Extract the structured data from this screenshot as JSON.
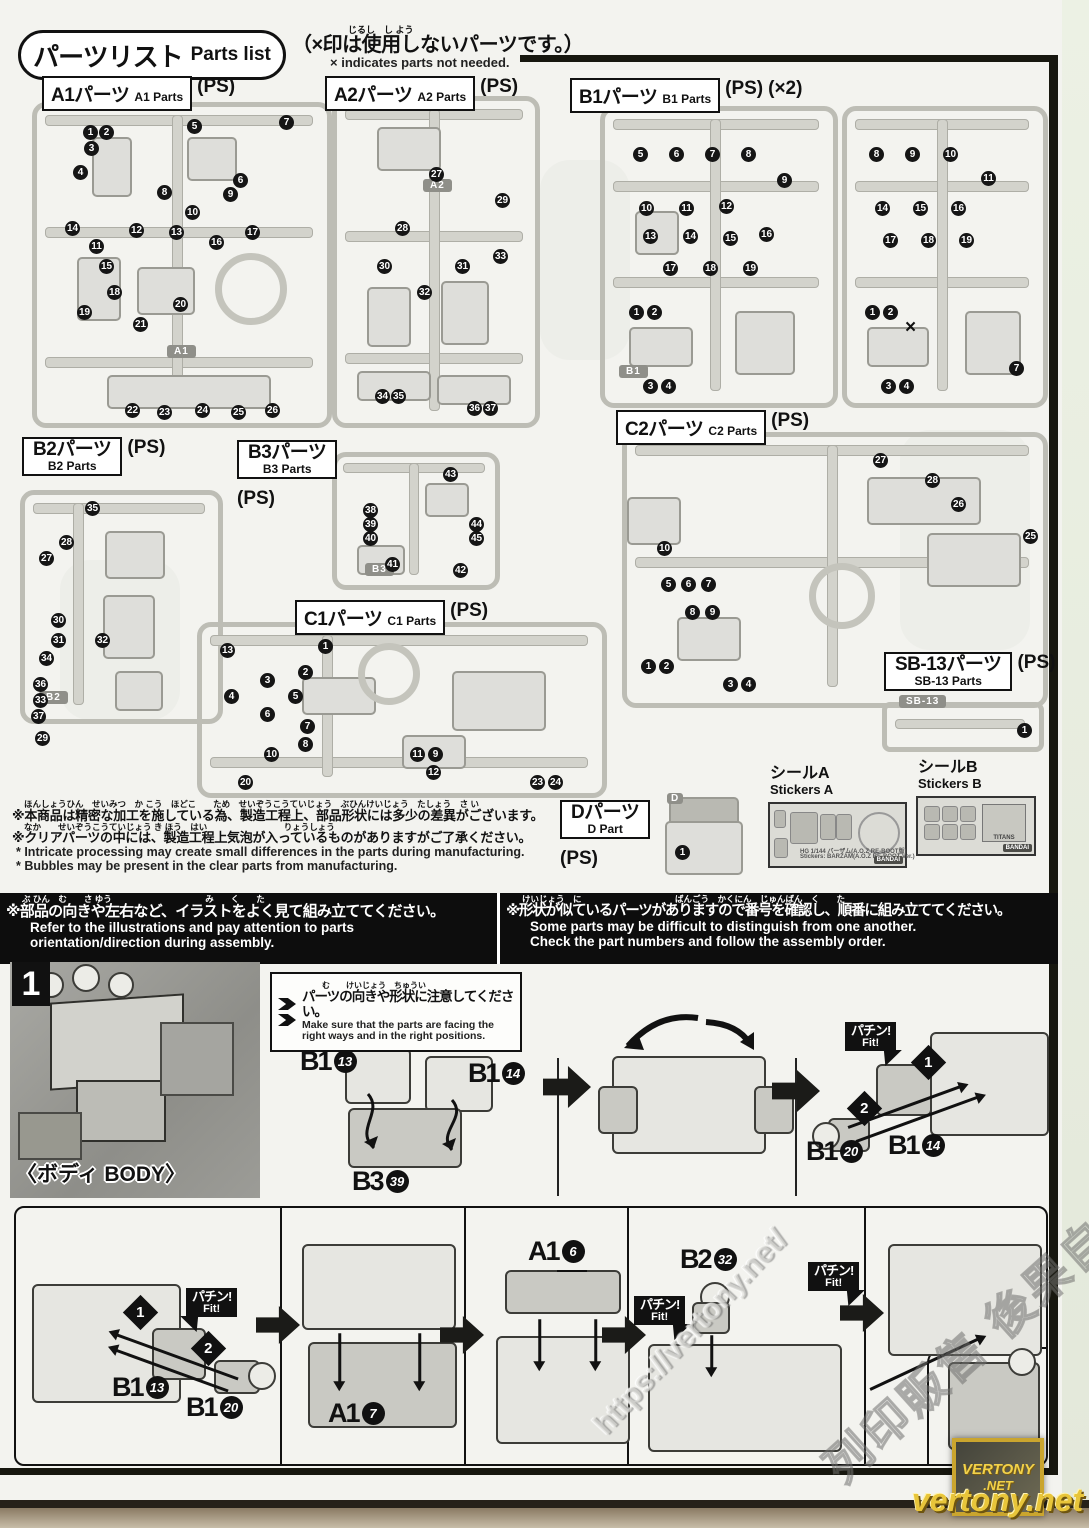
{
  "header": {
    "title_jp": "パーツリスト",
    "title_en": "Parts list",
    "x_note_furigana": "じるし　し よう",
    "x_note_jp": "（×印は使用しないパーツです。）",
    "x_note_en": "× indicates parts not needed."
  },
  "sections": {
    "a1": {
      "jp": "A1パーツ",
      "en": "A1 Parts",
      "ps": "(PS)",
      "tag": "A1"
    },
    "a2": {
      "jp": "A2パーツ",
      "en": "A2 Parts",
      "ps": "(PS)",
      "tag": "A2"
    },
    "b1": {
      "jp": "B1パーツ",
      "en": "B1 Parts",
      "ps": "(PS)",
      "qty": "(×2)",
      "tag": "B1"
    },
    "b2": {
      "jp": "B2パーツ",
      "en": "B2 Parts",
      "ps": "(PS)",
      "tag": "B2"
    },
    "b3": {
      "jp": "B3パーツ",
      "en": "B3 Parts",
      "ps": "(PS)",
      "tag": "B3"
    },
    "c1": {
      "jp": "C1パーツ",
      "en": "C1 Parts",
      "ps": "(PS)"
    },
    "c2": {
      "jp": "C2パーツ",
      "en": "C2 Parts",
      "ps": "(PS)"
    },
    "sb13": {
      "jp": "SB-13パーツ",
      "en": "SB-13 Parts",
      "ps": "(PS)",
      "tag": "SB-13"
    },
    "d": {
      "jp": "Dパーツ",
      "en": "D Part",
      "ps": "(PS)",
      "tag": "D"
    }
  },
  "sprues": {
    "a1": [
      [
        1,
        46,
        18
      ],
      [
        2,
        62,
        18
      ],
      [
        3,
        47,
        34
      ],
      [
        4,
        36,
        58
      ],
      [
        5,
        150,
        12
      ],
      [
        7,
        242,
        8
      ],
      [
        6,
        196,
        66
      ],
      [
        8,
        120,
        78
      ],
      [
        9,
        186,
        80
      ],
      [
        10,
        148,
        98
      ],
      [
        14,
        28,
        114
      ],
      [
        12,
        92,
        116
      ],
      [
        13,
        132,
        118
      ],
      [
        11,
        52,
        132
      ],
      [
        16,
        172,
        128
      ],
      [
        17,
        208,
        118
      ],
      [
        15,
        62,
        152
      ],
      [
        18,
        70,
        178
      ],
      [
        19,
        40,
        198
      ],
      [
        20,
        136,
        190
      ],
      [
        21,
        96,
        210
      ],
      [
        22,
        88,
        296
      ],
      [
        23,
        120,
        298
      ],
      [
        24,
        158,
        296
      ],
      [
        25,
        194,
        298
      ],
      [
        26,
        228,
        296
      ]
    ],
    "a2": [
      [
        27,
        92,
        66
      ],
      [
        28,
        58,
        120
      ],
      [
        29,
        158,
        92
      ],
      [
        30,
        40,
        158
      ],
      [
        31,
        118,
        158
      ],
      [
        32,
        80,
        184
      ],
      [
        33,
        156,
        148
      ],
      [
        34,
        38,
        288
      ],
      [
        35,
        54,
        288
      ],
      [
        36,
        130,
        300
      ],
      [
        37,
        146,
        300
      ]
    ],
    "b1a": [
      [
        5,
        28,
        36
      ],
      [
        6,
        64,
        36
      ],
      [
        7,
        100,
        36
      ],
      [
        8,
        136,
        36
      ],
      [
        9,
        172,
        62
      ],
      [
        10,
        34,
        90
      ],
      [
        11,
        74,
        90
      ],
      [
        12,
        114,
        88
      ],
      [
        13,
        38,
        118
      ],
      [
        14,
        78,
        118
      ],
      [
        15,
        118,
        120
      ],
      [
        16,
        154,
        116
      ],
      [
        17,
        58,
        150
      ],
      [
        18,
        98,
        150
      ],
      [
        19,
        138,
        150
      ],
      [
        1,
        24,
        194
      ],
      [
        2,
        42,
        194
      ],
      [
        3,
        38,
        268
      ],
      [
        4,
        56,
        268
      ]
    ],
    "b1b": [
      [
        8,
        22,
        36
      ],
      [
        9,
        58,
        36
      ],
      [
        10,
        96,
        36
      ],
      [
        11,
        134,
        60
      ],
      [
        14,
        28,
        90
      ],
      [
        15,
        66,
        90
      ],
      [
        16,
        104,
        90
      ],
      [
        17,
        36,
        122
      ],
      [
        18,
        74,
        122
      ],
      [
        19,
        112,
        122
      ],
      [
        1,
        18,
        194
      ],
      [
        2,
        36,
        194
      ],
      [
        "x",
        58,
        206
      ],
      [
        3,
        34,
        268
      ],
      [
        4,
        52,
        268
      ],
      [
        7,
        162,
        250
      ]
    ],
    "b2": [
      [
        35,
        60,
        6
      ],
      [
        28,
        34,
        40
      ],
      [
        27,
        14,
        56
      ],
      [
        30,
        26,
        118
      ],
      [
        31,
        26,
        138
      ],
      [
        32,
        70,
        138
      ],
      [
        34,
        14,
        156
      ],
      [
        36,
        8,
        182
      ],
      [
        33,
        8,
        198
      ],
      [
        37,
        6,
        214
      ],
      [
        29,
        10,
        236
      ]
    ],
    "b3": [
      [
        43,
        106,
        10
      ],
      [
        38,
        26,
        46
      ],
      [
        39,
        26,
        60
      ],
      [
        40,
        26,
        74
      ],
      [
        44,
        132,
        60
      ],
      [
        45,
        132,
        74
      ],
      [
        41,
        48,
        100
      ],
      [
        42,
        116,
        106
      ]
    ],
    "c1": [
      [
        13,
        18,
        16
      ],
      [
        1,
        116,
        12
      ],
      [
        2,
        96,
        38
      ],
      [
        3,
        58,
        46
      ],
      [
        4,
        22,
        62
      ],
      [
        5,
        86,
        62
      ],
      [
        6,
        58,
        80
      ],
      [
        7,
        98,
        92
      ],
      [
        8,
        96,
        110
      ],
      [
        10,
        62,
        120
      ],
      [
        11,
        208,
        120
      ],
      [
        9,
        226,
        120
      ],
      [
        12,
        224,
        138
      ],
      [
        20,
        36,
        148
      ],
      [
        23,
        328,
        148
      ],
      [
        24,
        346,
        148
      ]
    ],
    "c2": [
      [
        27,
        246,
        16
      ],
      [
        28,
        298,
        36
      ],
      [
        26,
        324,
        60
      ],
      [
        25,
        396,
        92
      ],
      [
        10,
        30,
        104
      ],
      [
        5,
        34,
        140
      ],
      [
        6,
        54,
        140
      ],
      [
        7,
        74,
        140
      ],
      [
        8,
        58,
        168
      ],
      [
        9,
        78,
        168
      ],
      [
        1,
        14,
        222
      ],
      [
        2,
        32,
        222
      ],
      [
        3,
        96,
        240
      ],
      [
        4,
        114,
        240
      ]
    ],
    "sb13": [
      [
        1,
        130,
        16
      ]
    ],
    "d": [
      [
        1,
        10,
        48
      ]
    ]
  },
  "stickers": {
    "a": {
      "jp": "シールA",
      "en": "Stickers A",
      "line1": "HG 1/144 バーザム(A.O.Z RE-BOOT版)",
      "line2": "Stickers: BARZAM(A.O.Z RE-BOOT Ver.)",
      "logo": "BANDAI"
    },
    "b": {
      "jp": "シールB",
      "en": "Stickers B",
      "emblem": "TITANS",
      "logo": "BANDAI"
    }
  },
  "notes": {
    "f1": "ほんしょうひん　せいみつ　か こう　ほどこ　　ため　せいぞうこうていじょう　ぶひんけいじょう　たしょう　さ い",
    "jp1": "※本商品は精密な加工を施している為、製造工程上、部品形状には多少の差異がございます。",
    "f2": "なか　　せいぞうこうていじょう き ほう　はい　　　　　　　　　りょうしょう",
    "jp2": "※クリアパーツの中には、製造工程上気泡が入っているものがありますがご了承ください。",
    "en1": "* Intricate processing may create small differences in the parts during manufacturing.",
    "en2": "* Bubbles may be present in the clear parts from manufacturing."
  },
  "warn": {
    "lf": "ぶ ひん　む　　さ ゆう　　　　　　　　　　　み　　く　　た",
    "ljp": "※部品の向きや左右など、イラストをよく見て組み立ててください。",
    "len1": "Refer to the illustrations and pay attention to parts",
    "len2": "orientation/direction during assembly.",
    "rf": "けいじょう　に　　　　　　　　　　　ばんごう　かくにん　じゅんばん　く　　た",
    "rjp": "※形状が似ているパーツがありますので番号を確認し、順番に組み立ててください。",
    "ren1": "Some parts may be difficult to distinguish from one another.",
    "ren2": "Check the part numbers and follow the assembly order."
  },
  "step1": {
    "num": "1",
    "body_label": "〈ボディ BODY〉",
    "callout": {
      "fu": "む　　けいじょう　ちゅうい",
      "jp": "パーツの向きや形状に注意してください。",
      "en1": "Make sure that the parts are facing the",
      "en2": "right ways and in the right positions."
    },
    "fit": {
      "jp": "パチン!",
      "en": "Fit!"
    },
    "m1": "1",
    "m2": "2"
  },
  "refs": {
    "b1_13": {
      "p": "B1",
      "n": "13"
    },
    "b1_14": {
      "p": "B1",
      "n": "14"
    },
    "b3_39": {
      "p": "B3",
      "n": "39"
    },
    "b1_20": {
      "p": "B1",
      "n": "20"
    },
    "a1_7": {
      "p": "A1",
      "n": "7"
    },
    "a1_6": {
      "p": "A1",
      "n": "6"
    },
    "b2_32": {
      "p": "B2",
      "n": "32"
    }
  },
  "wm": {
    "url": "https://vertony.net/",
    "cn": "列印販售 後果自負",
    "logo_top": "VERTONY",
    "logo_bottom": ".NET",
    "site": "vertony.net"
  }
}
